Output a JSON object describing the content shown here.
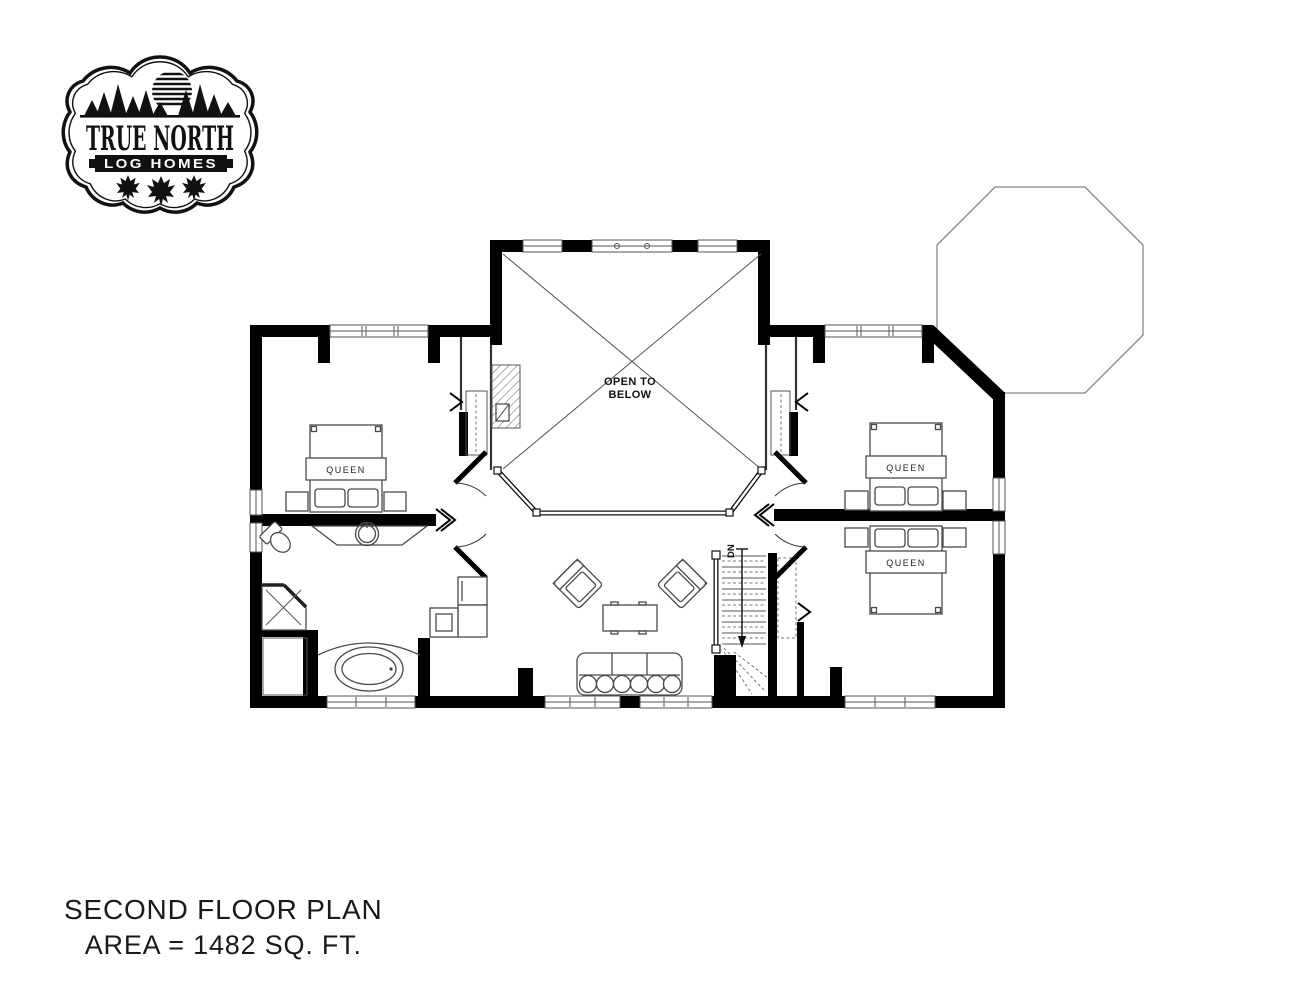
{
  "logo": {
    "title": "TRUE NORTH",
    "subtitle": "LOG HOMES"
  },
  "plan": {
    "labels": {
      "open_to_below_line1": "OPEN TO",
      "open_to_below_line2": "BELOW",
      "stairs_direction": "DN"
    },
    "beds": {
      "left_bedroom": "QUEEN",
      "right_bedroom_upper": "QUEEN",
      "right_bedroom_lower": "QUEEN"
    }
  },
  "title_block": {
    "line1": "SECOND FLOOR PLAN",
    "line2": "AREA = 1482 SQ. FT."
  },
  "colors": {
    "walls": "#000000",
    "furniture_lines": "#4a4a4a",
    "text": "#1a1a1a"
  }
}
